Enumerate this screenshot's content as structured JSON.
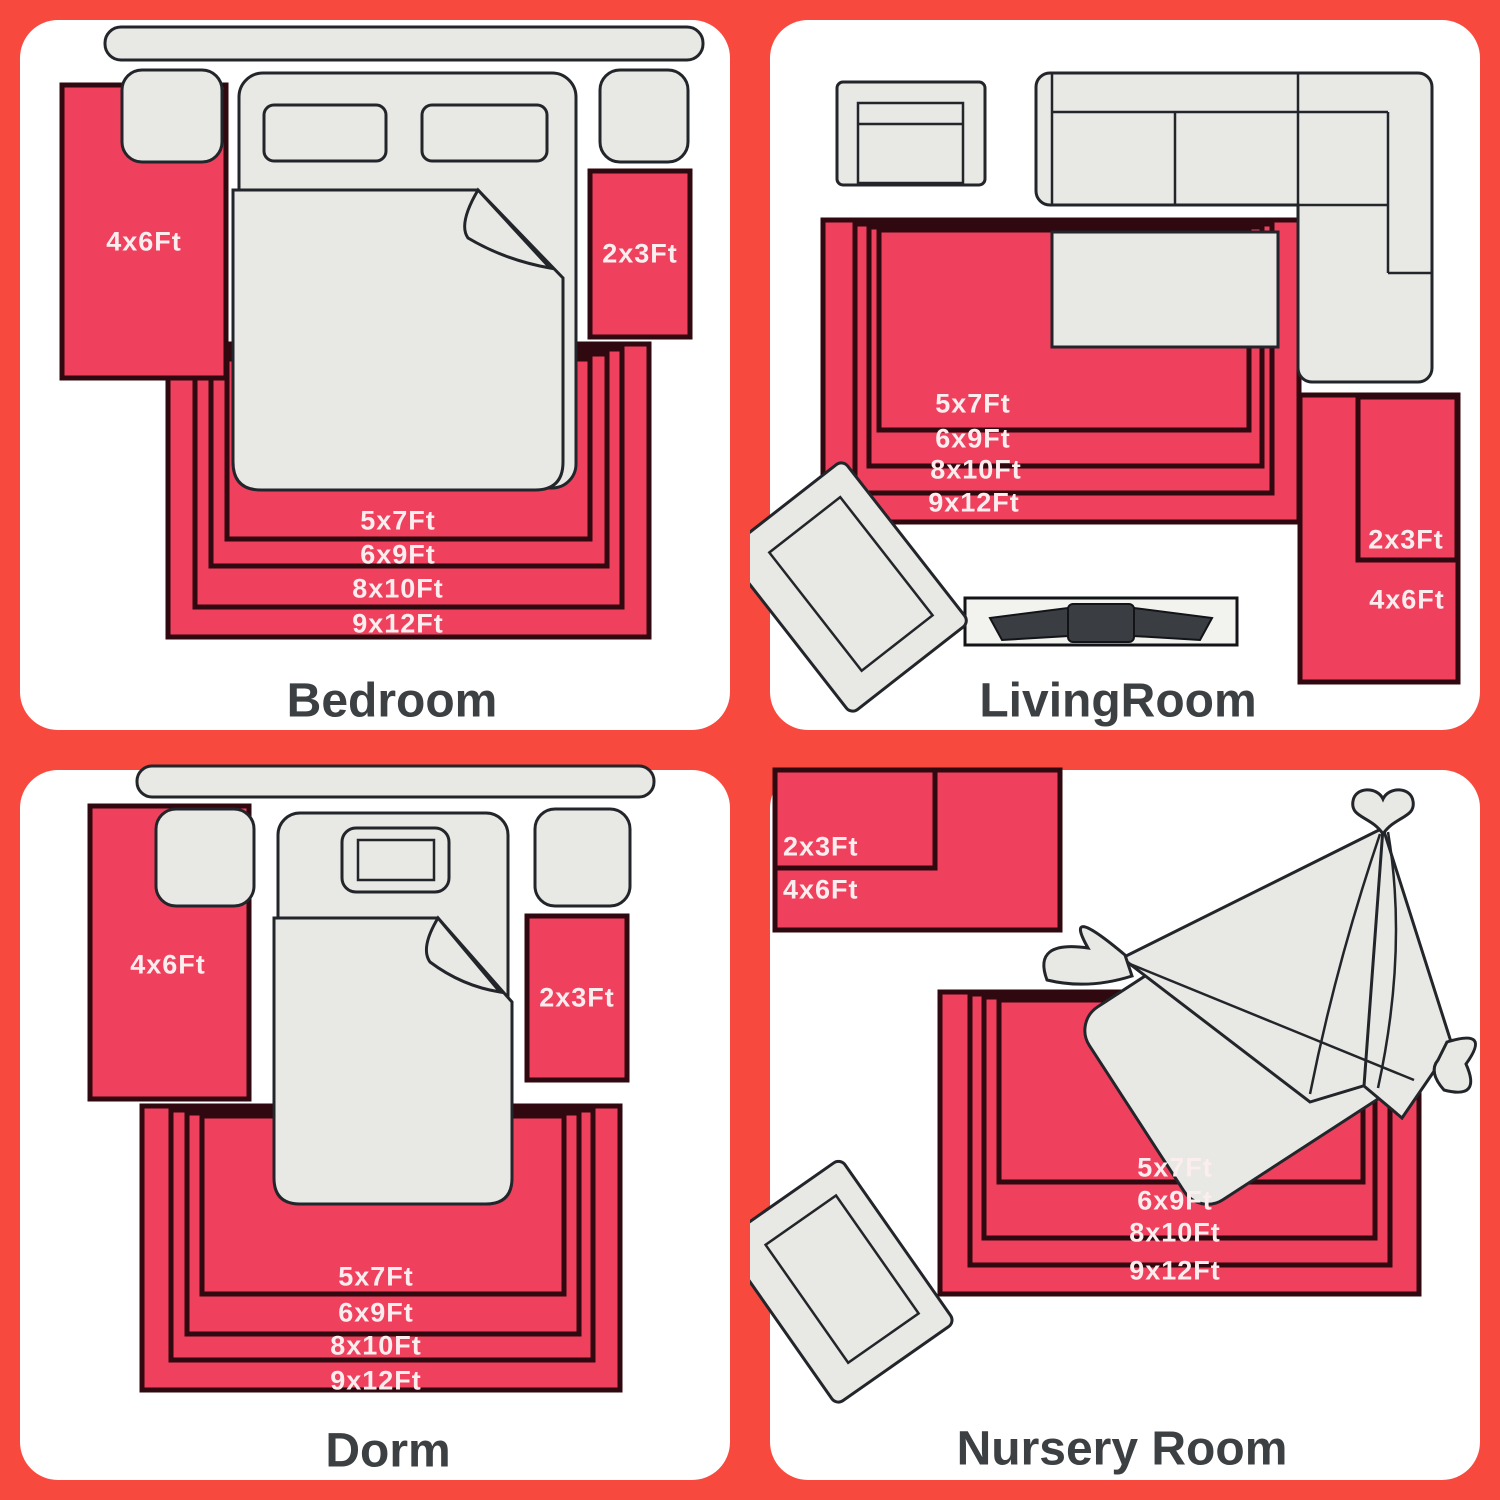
{
  "image_title": "Rug size comparison guide for four rooms",
  "colors": {
    "background": "#F8493F",
    "panel": "#FFFFFF",
    "rug_fill": "#EF415E",
    "rug_border": "#30080F",
    "furniture_fill": "#E8E8E4",
    "furniture_outline": "#22252A",
    "title_text": "#3C4043",
    "size_label_text": "#FCEDEF"
  },
  "panels": [
    {
      "title": "Bedroom",
      "sizes": {
        "left": "4x6Ft",
        "right": "2x3Ft",
        "nested": [
          "5x7Ft",
          "6x9Ft",
          "8x10Ft",
          "9x12Ft"
        ]
      }
    },
    {
      "title": "LivingRoom",
      "sizes": {
        "side_inner": "2x3Ft",
        "side_outer": "4x6Ft",
        "nested": [
          "5x7Ft",
          "6x9Ft",
          "8x10Ft",
          "9x12Ft"
        ]
      }
    },
    {
      "title": "Dorm",
      "sizes": {
        "left": "4x6Ft",
        "right": "2x3Ft",
        "nested": [
          "5x7Ft",
          "6x9Ft",
          "8x10Ft",
          "9x12Ft"
        ]
      }
    },
    {
      "title": "Nursery Room",
      "sizes": {
        "corner_inner": "2x3Ft",
        "corner_outer": "4x6Ft",
        "nested": [
          "5x7Ft",
          "6x9Ft",
          "8x10Ft",
          "9x12Ft"
        ]
      }
    }
  ]
}
